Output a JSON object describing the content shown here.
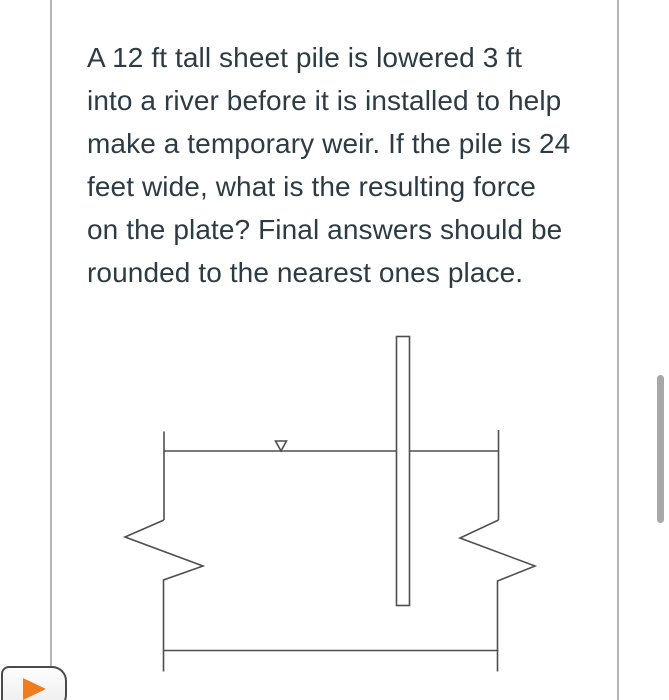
{
  "question": {
    "lines": [
      "A 12 ft tall sheet pile is lowered 3 ft",
      "into a river before it is installed to help",
      "make a temporary weir. If the pile is 24",
      "feet wide, what is the resulting force",
      "on the plate? Final answers should be",
      "rounded to the nearest ones place."
    ],
    "full_text": "A 12 ft tall sheet pile is lowered 3 ft into a river before it is installed to help make a temporary weir. If the pile is 24 feet wide, what is the resulting force on the plate? Final answers should be rounded to the nearest ones place.",
    "text_color": "#2d3b45"
  },
  "figure": {
    "description": "river-cross-section-with-sheet-pile-weir",
    "elements": {
      "sheet_pile": "tall narrow vertical rectangle crossing the water surface",
      "water_surface_marker": "open downward triangle (free-surface symbol) on the waterline",
      "channel_breaks": "zigzag break symbols on left and right channel walls"
    },
    "line_color": "#4f4f4f"
  },
  "scrollbar": {
    "thumb_color": "#a8a8a8"
  },
  "media_player": {
    "play_icon": "orange right-pointing triangle",
    "accent_color": "#f07c1d"
  }
}
